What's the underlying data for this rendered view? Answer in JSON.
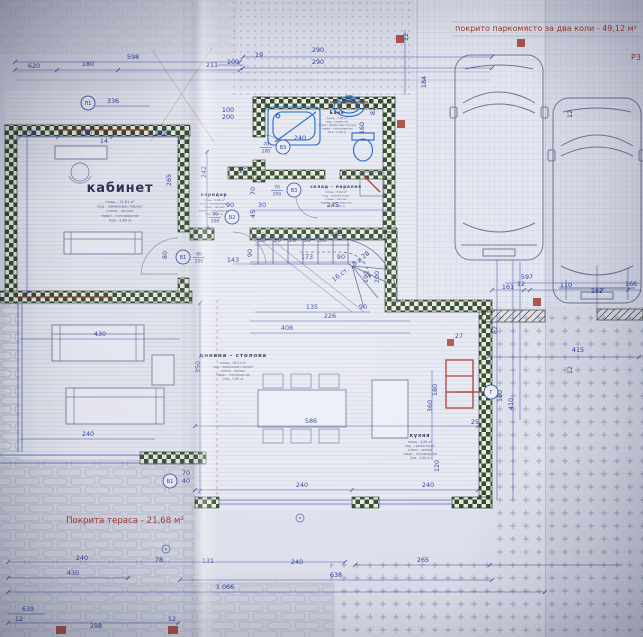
{
  "palette": {
    "ink": "#2b3e9c",
    "wall_dark": "#2c4a34",
    "wall_light": "#ece8da",
    "red": "#a33a2f",
    "paper": "#dde0eb"
  },
  "parking": {
    "title": "покрито паркомясто за два коли - 49,12 м²"
  },
  "terrace": {
    "label": "Покрита тераса - 21,68 м²"
  },
  "notes": {
    "corner": "Р3"
  },
  "stair": {
    "t": "16 ст. 18 х 28",
    "x": 352,
    "y": 268,
    "rot": -38
  },
  "rooms": [
    {
      "id": "kabinet",
      "name": "кабинет",
      "nx": 120,
      "ny": 192,
      "nsize": 13,
      "specs": [
        "площ - 14,61 м²",
        "под - ламиниран паркет",
        "стени - латекс",
        "таван - гипсокартон",
        "Нсв - 2,60 м"
      ],
      "sx": 120,
      "sy": 203,
      "ssize": 3.6,
      "slh": 4.6
    },
    {
      "id": "banya",
      "name": "Баня",
      "nx": 337,
      "ny": 114,
      "nsize": 4.2,
      "specs": [
        "площ - 3,85 м²",
        "под - теракота",
        "стени - фаянсови плочки",
        "таван - гипсокартон",
        "Нсв - 2,60 м"
      ],
      "sx": 337,
      "sy": 119,
      "ssize": 2.9,
      "slh": 3.5
    },
    {
      "id": "koridor",
      "name": "коридор",
      "nx": 214,
      "ny": 196,
      "nsize": 4.2,
      "specs": [
        "площ - 3,64 м²",
        "под - гранитогрес",
        "стени - латекс",
        "таван - гипсокартон",
        "Нсв - 2,60 м"
      ],
      "sx": 214,
      "sy": 201,
      "ssize": 2.9,
      "slh": 3.5
    },
    {
      "id": "sklad",
      "name": "склад - пералня",
      "nx": 336,
      "ny": 188,
      "nsize": 4.2,
      "specs": [
        "площ - 3,92 м²",
        "под - гранитогрес",
        "стени - латекс",
        "таван - гипсокартон",
        "Нсв - 2,60 м"
      ],
      "sx": 336,
      "sy": 193,
      "ssize": 2.9,
      "slh": 3.5
    },
    {
      "id": "dnevna",
      "name": "дневна - столова",
      "nx": 233,
      "ny": 357,
      "nsize": 5.6,
      "specs": [
        "площ - 38,21 м²",
        "под - ламиниран паркет",
        "стени - латекс",
        "таван - гипсокартон",
        "Нсв - 2,80 м"
      ],
      "sx": 233,
      "sy": 364,
      "ssize": 3.2,
      "slh": 4
    },
    {
      "id": "kuhnya",
      "name": "кухня",
      "nx": 420,
      "ny": 437,
      "nsize": 5,
      "specs": [
        "площ - 9,06 м²",
        "под - гранитогрес",
        "стени - латекс",
        "таван - гипсокартон",
        "Нсв - 2,60 м"
      ],
      "sx": 420,
      "sy": 443,
      "ssize": 3.2,
      "slh": 4
    }
  ],
  "doors": [
    {
      "tag": "В1",
      "size": "80/200",
      "cx": 183,
      "cy": 257,
      "side": 1
    },
    {
      "tag": "В2",
      "size": "90/200",
      "cx": 232,
      "cy": 217,
      "side": -1
    },
    {
      "tag": "В3",
      "size": "70/200",
      "cx": 283,
      "cy": 147,
      "side": -1
    },
    {
      "tag": "В3",
      "size": "70/200",
      "cx": 294,
      "cy": 190,
      "side": -1
    },
    {
      "tag": "П1",
      "size": "",
      "cx": 88,
      "cy": 103,
      "side": 1
    },
    {
      "tag": "Б1",
      "size": "",
      "cx": 170,
      "cy": 481,
      "side": 1
    },
    {
      "tag": "Г",
      "size": "",
      "cx": 491,
      "cy": 392,
      "side": 1
    }
  ],
  "columns": [
    {
      "x": 396,
      "y": 35,
      "w": 8,
      "h": 8
    },
    {
      "x": 517,
      "y": 39,
      "w": 8,
      "h": 8
    },
    {
      "x": 397,
      "y": 120,
      "w": 8,
      "h": 8
    },
    {
      "x": 533,
      "y": 298,
      "w": 8,
      "h": 8
    },
    {
      "x": 56,
      "y": 626,
      "w": 10,
      "h": 8
    },
    {
      "x": 168,
      "y": 626,
      "w": 10,
      "h": 8
    },
    {
      "x": 447,
      "y": 339,
      "w": 7,
      "h": 7
    }
  ],
  "dims": [
    {
      "t": "598",
      "x": 133,
      "y": 59
    },
    {
      "t": "620",
      "x": 34,
      "y": 68
    },
    {
      "t": "180",
      "x": 88,
      "y": 66
    },
    {
      "t": "211",
      "x": 212,
      "y": 67
    },
    {
      "t": "336",
      "x": 113,
      "y": 103
    },
    {
      "t": "95",
      "x": 33,
      "y": 135
    },
    {
      "t": "150",
      "x": 86,
      "y": 135
    },
    {
      "t": "169",
      "x": 160,
      "y": 135
    },
    {
      "t": "14",
      "x": 104,
      "y": 143
    },
    {
      "t": "100",
      "x": 233,
      "y": 64
    },
    {
      "t": "19",
      "x": 259,
      "y": 57
    },
    {
      "t": "290",
      "x": 318,
      "y": 52
    },
    {
      "t": "290",
      "x": 318,
      "y": 64
    },
    {
      "t": "12",
      "x": 408,
      "y": 37,
      "r": 1
    },
    {
      "t": "184",
      "x": 426,
      "y": 82,
      "r": 1
    },
    {
      "t": "240",
      "x": 300,
      "y": 140
    },
    {
      "t": "160",
      "x": 364,
      "y": 128,
      "r": 1
    },
    {
      "t": "82",
      "x": 375,
      "y": 111,
      "r": 1
    },
    {
      "t": "12",
      "x": 572,
      "y": 114,
      "r": 1
    },
    {
      "t": "12",
      "x": 572,
      "y": 370,
      "r": 1
    },
    {
      "t": "25",
      "x": 243,
      "y": 173
    },
    {
      "t": "100",
      "x": 228,
      "y": 112
    },
    {
      "t": "200",
      "x": 228,
      "y": 119
    },
    {
      "t": "242",
      "x": 206,
      "y": 172,
      "r": 1
    },
    {
      "t": "70",
      "x": 255,
      "y": 191,
      "r": 1
    },
    {
      "t": "245",
      "x": 333,
      "y": 207
    },
    {
      "t": "263",
      "x": 337,
      "y": 236
    },
    {
      "t": "30",
      "x": 262,
      "y": 242
    },
    {
      "t": "30",
      "x": 277,
      "y": 242
    },
    {
      "t": "30",
      "x": 292,
      "y": 242
    },
    {
      "t": "30",
      "x": 307,
      "y": 242
    },
    {
      "t": "30",
      "x": 322,
      "y": 242
    },
    {
      "t": "173",
      "x": 307,
      "y": 259
    },
    {
      "t": "90",
      "x": 252,
      "y": 253,
      "r": 1
    },
    {
      "t": "90",
      "x": 341,
      "y": 259
    },
    {
      "t": "135",
      "x": 312,
      "y": 309
    },
    {
      "t": "90",
      "x": 363,
      "y": 309
    },
    {
      "t": "226",
      "x": 330,
      "y": 318
    },
    {
      "t": "408",
      "x": 287,
      "y": 330
    },
    {
      "t": "190",
      "x": 368,
      "y": 277,
      "r": 1
    },
    {
      "t": "200",
      "x": 379,
      "y": 277,
      "r": 1
    },
    {
      "t": "430",
      "x": 100,
      "y": 336
    },
    {
      "t": "240",
      "x": 88,
      "y": 436
    },
    {
      "t": "350",
      "x": 200,
      "y": 367,
      "r": 1
    },
    {
      "t": "265",
      "x": 171,
      "y": 180,
      "r": 1
    },
    {
      "t": "80",
      "x": 167,
      "y": 255,
      "r": 1
    },
    {
      "t": "143",
      "x": 233,
      "y": 262
    },
    {
      "t": "90",
      "x": 230,
      "y": 207
    },
    {
      "t": "45",
      "x": 255,
      "y": 214,
      "r": 1
    },
    {
      "t": "30",
      "x": 262,
      "y": 207
    },
    {
      "t": "586",
      "x": 311,
      "y": 423
    },
    {
      "t": "240",
      "x": 302,
      "y": 487
    },
    {
      "t": "240",
      "x": 428,
      "y": 487
    },
    {
      "t": "120",
      "x": 439,
      "y": 466,
      "r": 1
    },
    {
      "t": "360",
      "x": 432,
      "y": 406,
      "r": 1
    },
    {
      "t": "180",
      "x": 437,
      "y": 390,
      "r": 1
    },
    {
      "t": "25",
      "x": 475,
      "y": 424
    },
    {
      "t": "27",
      "x": 459,
      "y": 338
    },
    {
      "t": "597",
      "x": 527,
      "y": 279
    },
    {
      "t": "161",
      "x": 508,
      "y": 289
    },
    {
      "t": "12",
      "x": 521,
      "y": 286
    },
    {
      "t": "110",
      "x": 566,
      "y": 287
    },
    {
      "t": "282",
      "x": 597,
      "y": 293
    },
    {
      "t": "166",
      "x": 631,
      "y": 286
    },
    {
      "t": "415",
      "x": 578,
      "y": 352
    },
    {
      "t": "82",
      "x": 497,
      "y": 330,
      "r": 1
    },
    {
      "t": "180",
      "x": 502,
      "y": 396,
      "r": 1
    },
    {
      "t": "410",
      "x": 513,
      "y": 404,
      "r": 1
    },
    {
      "t": "240",
      "x": 82,
      "y": 560
    },
    {
      "t": "78",
      "x": 159,
      "y": 562
    },
    {
      "t": "131",
      "x": 208,
      "y": 563
    },
    {
      "t": "240",
      "x": 297,
      "y": 564
    },
    {
      "t": "265",
      "x": 423,
      "y": 562
    },
    {
      "t": "430",
      "x": 73,
      "y": 575
    },
    {
      "t": "638",
      "x": 336,
      "y": 577
    },
    {
      "t": "1 066",
      "x": 225,
      "y": 589
    },
    {
      "t": "639",
      "x": 28,
      "y": 611
    },
    {
      "t": "12",
      "x": 19,
      "y": 621
    },
    {
      "t": "12",
      "x": 172,
      "y": 621
    },
    {
      "t": "298",
      "x": 96,
      "y": 628
    },
    {
      "t": "70",
      "x": 186,
      "y": 475
    },
    {
      "t": "40",
      "x": 186,
      "y": 483
    }
  ]
}
